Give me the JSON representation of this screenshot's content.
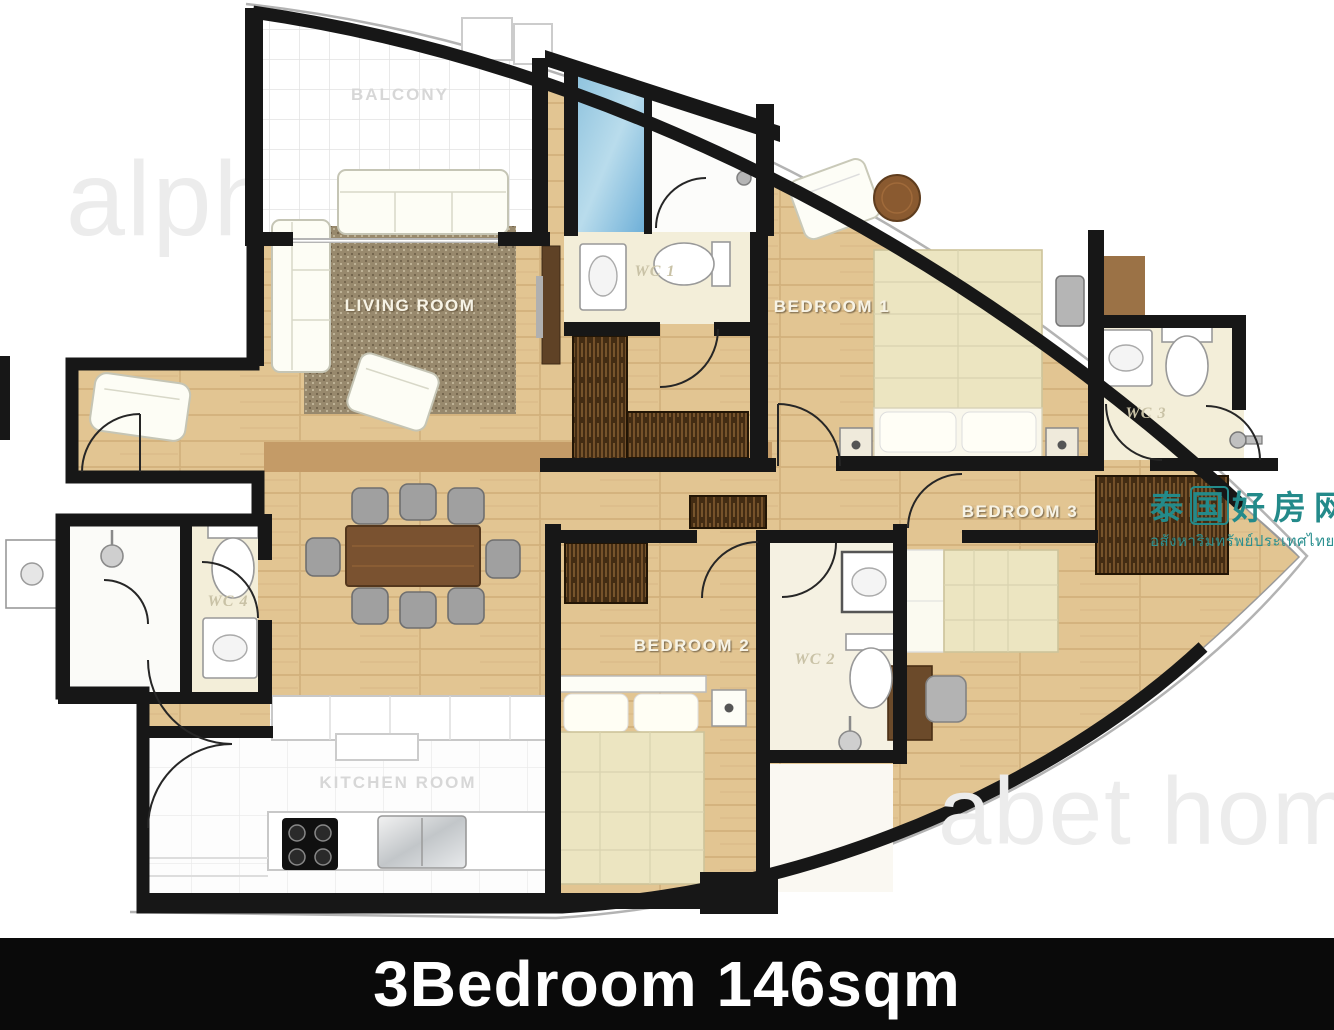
{
  "title": {
    "text": "3Bedroom 146sqm"
  },
  "watermarks": {
    "alphabet_left": "alph",
    "alphabet_right": "abet home",
    "chinese": "泰国好房网",
    "thai": "อสังหาริมทรัพย์ประเทศไทย"
  },
  "rooms": {
    "balcony": "BALCONY",
    "living_room": "LIVING ROOM",
    "wc1": "WC 1",
    "bedroom1": "BEDROOM 1",
    "wc3": "WC 3",
    "bedroom3": "BEDROOM 3",
    "bedroom2": "BEDROOM 2",
    "wc2": "WC 2",
    "wc4": "WC 4",
    "kitchen": "KITCHEN ROOM"
  },
  "colors": {
    "wall": "#171717",
    "wood_floor": "#e2c592",
    "wood_dark_band": "#c49b67",
    "wardrobe_wood": "#432c13",
    "bath_floor": "#f3eed9",
    "glass_blue": "#6fb0d8",
    "rug": "#98896d",
    "watermark_teal": "#238a8a",
    "watermark_gray": "#ececec",
    "title_bg": "#0a0a0a",
    "title_text": "#ffffff"
  }
}
